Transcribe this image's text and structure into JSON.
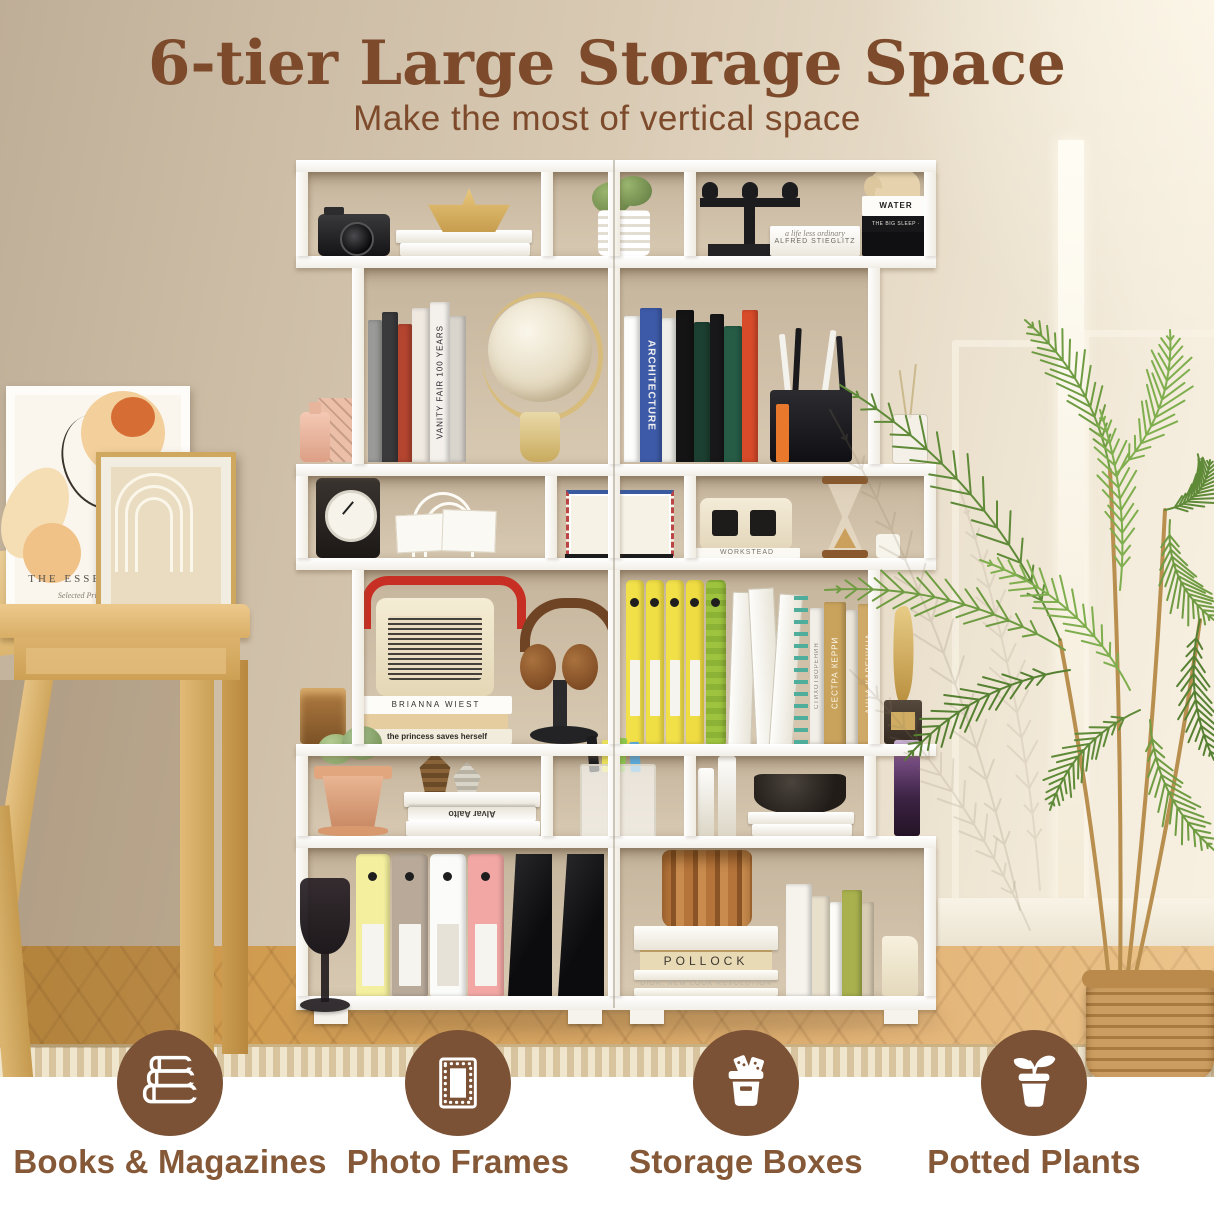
{
  "header": {
    "title": "6-tier Large Storage Space",
    "subtitle": "Make the most of vertical space"
  },
  "features": [
    {
      "icon": "books-icon",
      "label": "Books & Magazines"
    },
    {
      "icon": "photo-frame-icon",
      "label": "Photo Frames"
    },
    {
      "icon": "storage-box-icon",
      "label": "Storage Boxes"
    },
    {
      "icon": "potted-plant-icon",
      "label": "Potted Plants"
    }
  ],
  "colors": {
    "title_brown": "#7d4b2c",
    "label_brown": "#855837",
    "icon_circle_brown": "#7b5236",
    "shelf_white": "#fbfaf7",
    "wall_beige": "#d8c9b4",
    "floor_wood": "#d7a45f",
    "palm_green": "#6b9141",
    "rug_beige": "#e8d7b2"
  },
  "frame_art": {
    "title": "THE ESSENCE O",
    "subtitle": "Selected Prints 190"
  },
  "shelf_texts": {
    "water": "WATER",
    "finance": "FINANCE",
    "big_sleep": "THE BIG SLEEP · RAYMOND CHANDLER",
    "stieglitz_line1": "a life less ordinary",
    "stieglitz_line2": "ALFRED STIEGLITZ",
    "vanity_fair": "VANITY FAIR 100 YEARS",
    "architecture": "ARCHITECTURE",
    "workstead": "WORKSTEAD",
    "brianna": "BRIANNA WIEST",
    "princess": "the princess saves herself",
    "alvar": "Alvar Aalto",
    "stikhotvoreniya": "СТИХОТВОРЕНИЯ",
    "sestra_kerri": "СЕСТРА КЕРРИ",
    "anna_karenina": "АННА КАРЕНИНА",
    "pollock": "POLLOCK",
    "dior": "DIOR: NEW LOOK REVOLUTION"
  }
}
